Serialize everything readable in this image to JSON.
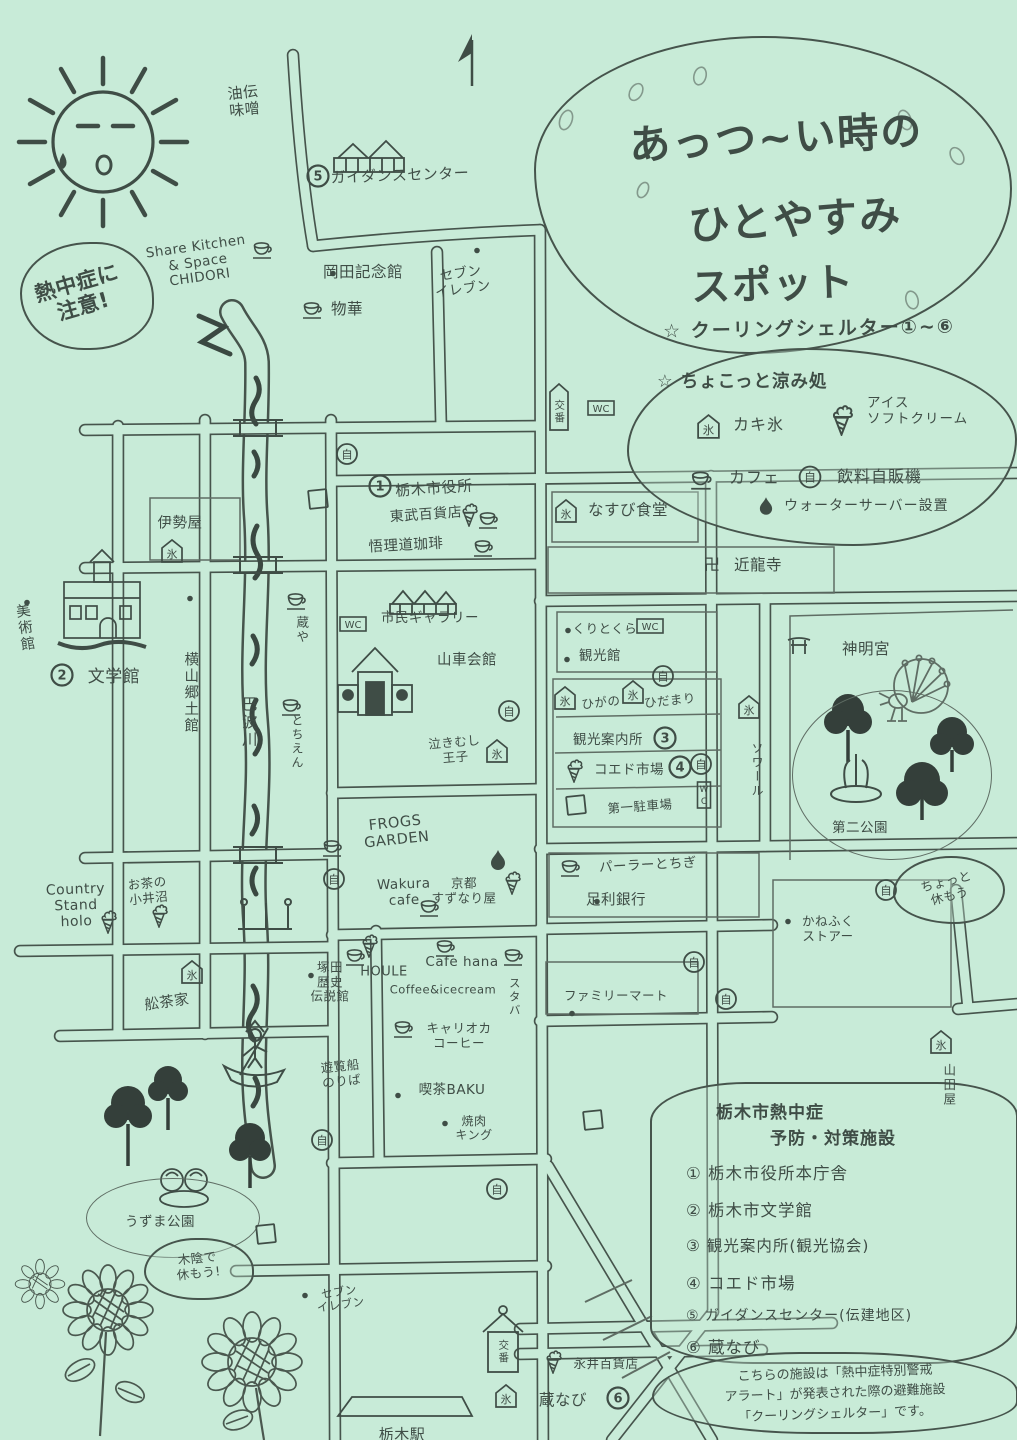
{
  "canvas": {
    "bg": "#c8ebd8",
    "ink": "#3f4d46",
    "pencil": "#5f6d64"
  },
  "glyphs": {
    "iceflag": "氷",
    "jido": "自",
    "parking": "P",
    "wc": "WC",
    "wcv": "WC",
    "manji": "卍",
    "star": "☆"
  },
  "title": {
    "line1": "あっつ~い時の",
    "line2": "ひとやすみ",
    "line3": "スポット",
    "subtitle": "☆ クーリングシェルター①~⑥"
  },
  "legend": {
    "header": "☆ ちょこっと涼み処",
    "shaved_ice": "カキ氷",
    "soft_cream": "アイス\nソフトクリーム",
    "cafe": "カフェ",
    "vending": "飲料自販機",
    "water_server": "ウォーターサーバー設置"
  },
  "facilities": {
    "heading_line1": "栃木市熱中症",
    "heading_line2": "予防・対策施設",
    "items": [
      "① 栃木市役所本庁舎",
      "② 栃木市文学館",
      "③ 観光案内所(観光協会)",
      "④ コエド市場",
      "⑤ ガイダンスセンター(伝建地区)",
      "⑥ 蔵なび"
    ]
  },
  "note": {
    "line1": "こちらの施設は「熱中症特別警戒",
    "line2": "アラート」が発表された際の避難施設",
    "line3": "「クーリングシェルター」です。"
  },
  "map": {
    "labels": [
      {
        "n": "aburaden-miso",
        "t": "油伝\n味噌",
        "x": 244,
        "y": 102,
        "fs": 15,
        "rot": -6
      },
      {
        "n": "guidance-center",
        "t": "ガイダンスセンター",
        "x": 400,
        "y": 176,
        "fs": 15,
        "rot": -2
      },
      {
        "n": "share-kitchen-chidori",
        "t": "Share Kitchen\n& Space\nCHIDORI",
        "x": 198,
        "y": 263,
        "fs": 13.5,
        "rot": -8
      },
      {
        "n": "heatstroke-warning",
        "t": "熱中症に\n注意!",
        "x": 80,
        "y": 295,
        "fs": 21,
        "rot": -16,
        "b": 1
      },
      {
        "n": "okada-kinenkan",
        "t": "岡田記念館",
        "x": 363,
        "y": 273,
        "fs": 15.5
      },
      {
        "n": "seven-eleven-north",
        "t": "セブン\nイレブン",
        "x": 462,
        "y": 282,
        "fs": 13.5,
        "rot": -8
      },
      {
        "n": "bukka",
        "t": "物華",
        "x": 347,
        "y": 310,
        "fs": 15.5
      },
      {
        "n": "iseya",
        "t": "伊勢屋",
        "x": 180,
        "y": 524,
        "fs": 14.5
      },
      {
        "n": "city-hall",
        "t": "栃木市役所",
        "x": 434,
        "y": 489,
        "fs": 15,
        "rot": -4
      },
      {
        "n": "tobu-department",
        "t": "東武百貨店",
        "x": 426,
        "y": 515,
        "fs": 14,
        "rot": -4
      },
      {
        "n": "gorido-coffee",
        "t": "悟理道珈琲",
        "x": 406,
        "y": 546,
        "fs": 14.5,
        "rot": -3
      },
      {
        "n": "nasubi-shokudo",
        "t": "なすび食堂",
        "x": 628,
        "y": 511,
        "fs": 15.5
      },
      {
        "n": "kinryuji",
        "t": "近龍寺",
        "x": 758,
        "y": 566,
        "fs": 15.5
      },
      {
        "n": "art-museum",
        "t": "美術館",
        "x": 24,
        "y": 628,
        "fs": 14.5,
        "v": 1,
        "rot": -8
      },
      {
        "n": "literature-museum",
        "t": "文学館",
        "x": 114,
        "y": 678,
        "fs": 17
      },
      {
        "n": "yokoyama-kyodokan",
        "t": "横山郷土館",
        "x": 190,
        "y": 693,
        "fs": 14.5,
        "v": 1
      },
      {
        "n": "uzuma-river",
        "t": "巴波川",
        "x": 248,
        "y": 722,
        "fs": 15.5,
        "v": 1
      },
      {
        "n": "kuraya",
        "t": "蔵や",
        "x": 301,
        "y": 630,
        "fs": 12.5,
        "v": 1
      },
      {
        "n": "tochien",
        "t": "とちえん",
        "x": 297,
        "y": 742,
        "fs": 12,
        "v": 1
      },
      {
        "n": "city-gallery",
        "t": "市民ギャラリー",
        "x": 430,
        "y": 619,
        "fs": 13.5
      },
      {
        "n": "dashi-kaikan",
        "t": "山車会館",
        "x": 467,
        "y": 661,
        "fs": 14.5
      },
      {
        "n": "nakimushi-oji",
        "t": "泣きむし\n王子",
        "x": 455,
        "y": 750,
        "fs": 12.5,
        "rot": -5
      },
      {
        "n": "kuritokura",
        "t": "くりとくら",
        "x": 605,
        "y": 629,
        "fs": 12.5
      },
      {
        "n": "kankokan",
        "t": "観光館",
        "x": 600,
        "y": 657,
        "fs": 13.5
      },
      {
        "n": "higano",
        "t": "ひがの",
        "x": 601,
        "y": 703,
        "fs": 12.5,
        "rot": -6
      },
      {
        "n": "hidamari",
        "t": "ひだまり",
        "x": 670,
        "y": 701,
        "fs": 12.5,
        "rot": -6
      },
      {
        "n": "kanko-annaijo",
        "t": "観光案内所",
        "x": 608,
        "y": 741,
        "fs": 13.5
      },
      {
        "n": "koedo-ichiba",
        "t": "コエド市場",
        "x": 629,
        "y": 771,
        "fs": 13.5
      },
      {
        "n": "daiichi-parking",
        "t": "第一駐車場",
        "x": 640,
        "y": 807,
        "fs": 12.5,
        "rot": -4
      },
      {
        "n": "soir",
        "t": "ソワール",
        "x": 757,
        "y": 770,
        "fs": 12,
        "v": 1
      },
      {
        "n": "shinmeigu",
        "t": "神明宮",
        "x": 866,
        "y": 650,
        "fs": 15.5
      },
      {
        "n": "daini-koen",
        "t": "第二公園",
        "x": 860,
        "y": 829,
        "fs": 13.5
      },
      {
        "n": "chotto-yasumou",
        "t": "ちょっと\n休もう",
        "x": 948,
        "y": 889,
        "fs": 12.5,
        "rot": -14
      },
      {
        "n": "kanefuku-store",
        "t": "かねふく\nストアー",
        "x": 828,
        "y": 929,
        "fs": 12.5
      },
      {
        "n": "frogs-garden",
        "t": "FROGS\nGARDEN",
        "x": 396,
        "y": 832,
        "fs": 14.5,
        "rot": -6
      },
      {
        "n": "wakura-cafe",
        "t": "Wakura\ncafe",
        "x": 404,
        "y": 893,
        "fs": 13.5,
        "rot": -2
      },
      {
        "n": "kyoto-suzunariya",
        "t": "京都\nすずなり屋",
        "x": 464,
        "y": 891,
        "fs": 12.5
      },
      {
        "n": "parlor-tochigi",
        "t": "パーラーとちぎ",
        "x": 648,
        "y": 866,
        "fs": 13.5,
        "rot": -3
      },
      {
        "n": "ashikaga-bank",
        "t": "足利銀行",
        "x": 616,
        "y": 901,
        "fs": 14.5
      },
      {
        "n": "family-mart",
        "t": "ファミリーマート",
        "x": 616,
        "y": 996,
        "fs": 12.5
      },
      {
        "n": "country-stand-holo",
        "t": "Country\nStand\nholo",
        "x": 76,
        "y": 906,
        "fs": 14,
        "rot": -2
      },
      {
        "n": "ochano-oinuma",
        "t": "お茶の\n小井沼",
        "x": 148,
        "y": 891,
        "fs": 12.5,
        "rot": -6
      },
      {
        "n": "funachaya",
        "t": "舩茶家",
        "x": 167,
        "y": 1003,
        "fs": 14.5,
        "rot": -8
      },
      {
        "n": "tsukada-museum",
        "t": "塚田\n歴史\n伝説館",
        "x": 330,
        "y": 982,
        "fs": 12.5
      },
      {
        "n": "houle",
        "t": "HOULE",
        "x": 384,
        "y": 972,
        "fs": 13
      },
      {
        "n": "cafe-hana",
        "t": "Cafe hana",
        "x": 462,
        "y": 963,
        "fs": 13.5
      },
      {
        "n": "coffee-icecream",
        "t": "Coffee&icecream",
        "x": 443,
        "y": 990,
        "fs": 11.5
      },
      {
        "n": "staba",
        "t": "スタバ",
        "x": 514,
        "y": 997,
        "fs": 11.5,
        "v": 1
      },
      {
        "n": "carioca-coffee",
        "t": "キャリオカ\nコーヒー",
        "x": 459,
        "y": 1036,
        "fs": 12.5
      },
      {
        "n": "pleasure-boat-dock",
        "t": "遊覧船\nのりば",
        "x": 341,
        "y": 1074,
        "fs": 12.5,
        "rot": -6
      },
      {
        "n": "kissa-baku",
        "t": "喫茶BAKU",
        "x": 452,
        "y": 1091,
        "fs": 13.5
      },
      {
        "n": "yakiniku-king",
        "t": "焼肉\nキング",
        "x": 474,
        "y": 1129,
        "fs": 12
      },
      {
        "n": "uzuma-park",
        "t": "うずま公園",
        "x": 160,
        "y": 1223,
        "fs": 13.5
      },
      {
        "n": "kokage-yasumou",
        "t": "木陰で\n休もう!",
        "x": 198,
        "y": 1266,
        "fs": 12.5,
        "rot": -6
      },
      {
        "n": "seven-eleven-south",
        "t": "セブン\nイレブン",
        "x": 340,
        "y": 1299,
        "fs": 11.5,
        "rot": -8
      },
      {
        "n": "nagai-department",
        "t": "永井百貨店",
        "x": 606,
        "y": 1364,
        "fs": 12.5
      },
      {
        "n": "kuranavi",
        "t": "蔵なび",
        "x": 563,
        "y": 1401,
        "fs": 15.5
      },
      {
        "n": "yamadaya",
        "t": "山田屋",
        "x": 948,
        "y": 1085,
        "fs": 12.5,
        "v": 1
      },
      {
        "n": "tochigi-station",
        "t": "栃木駅",
        "x": 402,
        "y": 1435,
        "fs": 15
      },
      {
        "n": "koban-north",
        "t": "交番",
        "x": 559,
        "y": 412,
        "fs": 10.5,
        "v": 1
      },
      {
        "n": "koban-south",
        "t": "交番",
        "x": 503,
        "y": 1352,
        "fs": 10.5,
        "v": 1
      }
    ],
    "markers": [
      {
        "k": "iceflag",
        "x": 172,
        "y": 553,
        "n": "iseya"
      },
      {
        "k": "iceflag",
        "x": 566,
        "y": 513,
        "n": "nasubi"
      },
      {
        "k": "iceflag",
        "x": 497,
        "y": 753,
        "n": "nakimushi"
      },
      {
        "k": "iceflag",
        "x": 565,
        "y": 700,
        "n": "higano"
      },
      {
        "k": "iceflag",
        "x": 633,
        "y": 694,
        "n": "hidamari"
      },
      {
        "k": "iceflag",
        "x": 749,
        "y": 709,
        "n": "soir"
      },
      {
        "k": "iceflag",
        "x": 192,
        "y": 974,
        "n": "funachaya"
      },
      {
        "k": "iceflag",
        "x": 941,
        "y": 1044,
        "n": "yamadaya"
      },
      {
        "k": "iceflag",
        "x": 506,
        "y": 1398,
        "n": "kuranavi"
      },
      {
        "k": "cup",
        "x": 263,
        "y": 251,
        "n": "chidori"
      },
      {
        "k": "cup",
        "x": 313,
        "y": 311,
        "n": "bukka"
      },
      {
        "k": "cup",
        "x": 489,
        "y": 521,
        "n": "tobu"
      },
      {
        "k": "cup",
        "x": 484,
        "y": 549,
        "n": "gorido"
      },
      {
        "k": "cup",
        "x": 297,
        "y": 602,
        "n": "kuraya"
      },
      {
        "k": "cup",
        "x": 292,
        "y": 708,
        "n": "tochien"
      },
      {
        "k": "cup",
        "x": 333,
        "y": 849,
        "n": "frogs"
      },
      {
        "k": "cup",
        "x": 430,
        "y": 909,
        "n": "wakura"
      },
      {
        "k": "cup",
        "x": 571,
        "y": 869,
        "n": "parlor"
      },
      {
        "k": "cup",
        "x": 356,
        "y": 958,
        "n": "tsukada"
      },
      {
        "k": "cup",
        "x": 446,
        "y": 949,
        "n": "cafe-hana"
      },
      {
        "k": "cup",
        "x": 514,
        "y": 958,
        "n": "staba"
      },
      {
        "k": "cup",
        "x": 404,
        "y": 1030,
        "n": "carioca"
      },
      {
        "k": "soft",
        "x": 469,
        "y": 516,
        "n": "tobu"
      },
      {
        "k": "soft",
        "x": 574,
        "y": 772,
        "n": "koedo"
      },
      {
        "k": "soft",
        "x": 512,
        "y": 884,
        "n": "suzunariya"
      },
      {
        "k": "soft",
        "x": 108,
        "y": 923,
        "n": "holo"
      },
      {
        "k": "soft",
        "x": 159,
        "y": 917,
        "n": "oinuma"
      },
      {
        "k": "soft",
        "x": 369,
        "y": 947,
        "n": "tsukada"
      },
      {
        "k": "soft",
        "x": 553,
        "y": 1363,
        "n": "nagai"
      },
      {
        "k": "drop",
        "x": 498,
        "y": 862,
        "n": "suzunariya"
      },
      {
        "k": "jido",
        "x": 347,
        "y": 456,
        "n": "road-c"
      },
      {
        "k": "jido",
        "x": 509,
        "y": 713,
        "n": "dashi-kaikan"
      },
      {
        "k": "jido",
        "x": 663,
        "y": 678,
        "n": "hidamari"
      },
      {
        "k": "jido",
        "x": 701,
        "y": 766,
        "n": "koedo"
      },
      {
        "k": "jido",
        "x": 886,
        "y": 892,
        "n": "daini-koen"
      },
      {
        "k": "jido",
        "x": 694,
        "y": 964,
        "n": "famima-1"
      },
      {
        "k": "jido",
        "x": 726,
        "y": 1001,
        "n": "famima-2"
      },
      {
        "k": "jido",
        "x": 334,
        "y": 881,
        "n": "frogs"
      },
      {
        "k": "jido",
        "x": 322,
        "y": 1142,
        "n": "uzuma"
      },
      {
        "k": "jido",
        "x": 497,
        "y": 1191,
        "n": "station-north"
      },
      {
        "k": "pbox",
        "x": 318,
        "y": 501,
        "n": "tobu"
      },
      {
        "k": "pbox",
        "x": 576,
        "y": 807,
        "n": "daiichi"
      },
      {
        "k": "pbox",
        "x": 593,
        "y": 1122,
        "n": "south"
      },
      {
        "k": "pbox",
        "x": 266,
        "y": 1236,
        "n": "uzuma"
      },
      {
        "k": "wc",
        "x": 601,
        "y": 410,
        "n": "north"
      },
      {
        "k": "wc",
        "x": 353,
        "y": 626,
        "n": "gallery"
      },
      {
        "k": "wc",
        "x": 650,
        "y": 628,
        "n": "kuritokura"
      },
      {
        "k": "wcv",
        "x": 704,
        "y": 797,
        "n": "daiichi"
      },
      {
        "k": "num",
        "g": "1",
        "x": 380,
        "y": 488,
        "n": "shelter-1"
      },
      {
        "k": "num",
        "g": "2",
        "x": 62,
        "y": 677,
        "n": "shelter-2"
      },
      {
        "k": "num",
        "g": "3",
        "x": 665,
        "y": 740,
        "n": "shelter-3"
      },
      {
        "k": "num",
        "g": "4",
        "x": 680,
        "y": 769,
        "n": "shelter-4"
      },
      {
        "k": "num",
        "g": "5",
        "x": 318,
        "y": 178,
        "n": "shelter-5"
      },
      {
        "k": "num",
        "g": "6",
        "x": 618,
        "y": 1400,
        "n": "shelter-6"
      },
      {
        "k": "manji",
        "x": 712,
        "y": 566,
        "n": "kinryuji"
      },
      {
        "k": "torii",
        "x": 799,
        "y": 647,
        "n": "shinmeigu"
      },
      {
        "k": "banner",
        "x": 559,
        "y": 409,
        "n": "koban-north"
      },
      {
        "k": "dot",
        "x": 333,
        "y": 272,
        "n": "okada"
      },
      {
        "k": "dot",
        "x": 477,
        "y": 249,
        "n": "seven-north"
      },
      {
        "k": "dot",
        "x": 27,
        "y": 601,
        "n": "art-museum"
      },
      {
        "k": "dot",
        "x": 190,
        "y": 597,
        "n": "yokoyama"
      },
      {
        "k": "dot",
        "x": 568,
        "y": 629,
        "n": "kuritokura"
      },
      {
        "k": "dot",
        "x": 567,
        "y": 658,
        "n": "kankokan"
      },
      {
        "k": "dot",
        "x": 597,
        "y": 900,
        "n": "ashikaga"
      },
      {
        "k": "dot",
        "x": 572,
        "y": 1012,
        "n": "famima"
      },
      {
        "k": "dot",
        "x": 788,
        "y": 920,
        "n": "kanefuku"
      },
      {
        "k": "dot",
        "x": 311,
        "y": 974,
        "n": "tsukada"
      },
      {
        "k": "dot",
        "x": 398,
        "y": 1094,
        "n": "baku"
      },
      {
        "k": "dot",
        "x": 305,
        "y": 1294,
        "n": "seven-south"
      },
      {
        "k": "dot",
        "x": 445,
        "y": 1122,
        "n": "yakiniku"
      }
    ]
  }
}
